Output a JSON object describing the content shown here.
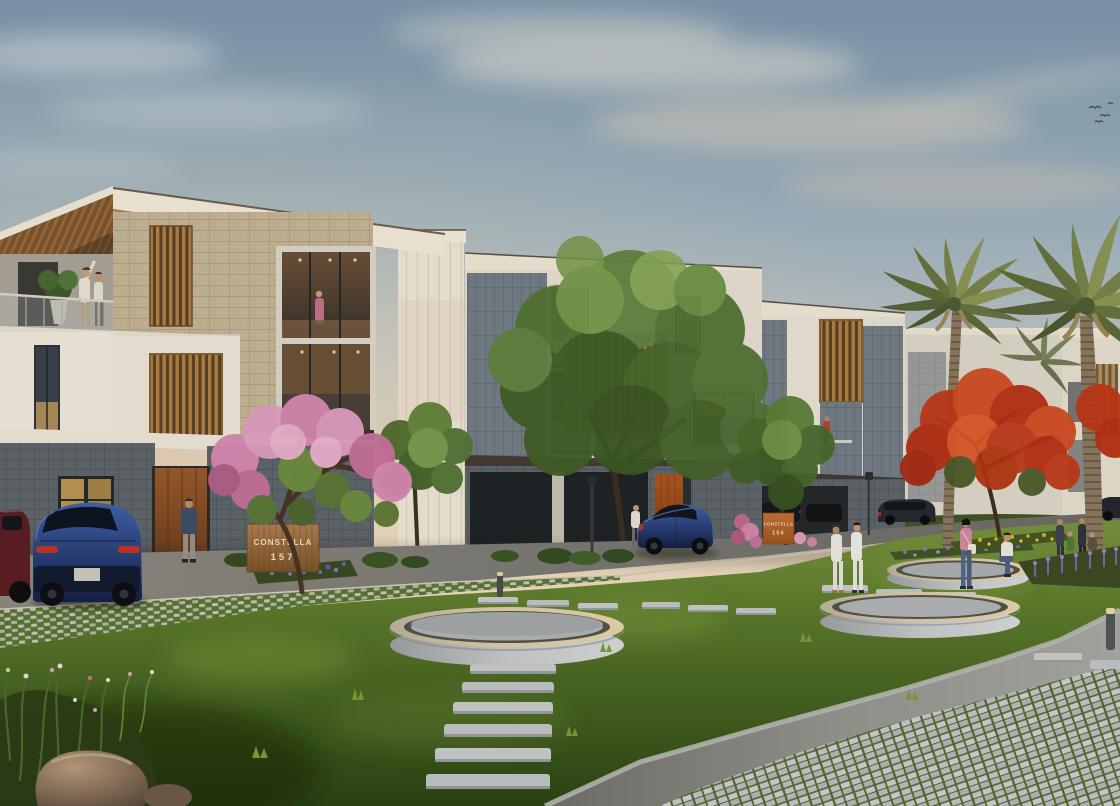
{
  "meta": {
    "title": "Residential community exterior rendering at dusk",
    "type": "architectural-visualization"
  },
  "signs": {
    "unit_left": {
      "name": "CONSTELLA",
      "number": "157"
    },
    "unit_right": {
      "name": "CONSTELLA",
      "number": "156"
    }
  },
  "palette": {
    "sky_top": "#7e98ae",
    "sky_horizon": "#f4e3c8",
    "stucco": "#f0e8d9",
    "stucco_shade": "#e4dccd",
    "stone_beige": "#c6b697",
    "stone_grey": "#78818a",
    "stone_dark": "#5f666c",
    "wood": "#b5803f",
    "wood_dark": "#55422a",
    "fascia_dark": "#423c36",
    "window_dark": "#2b333d",
    "window_lit": "#e9b261",
    "grass_light": "#7a9440",
    "grass_dark": "#2b4314",
    "asphalt": "#7b7873",
    "curb": "#d6cfc0",
    "paver_light": "#c6c9c4",
    "planter_band": "#ddcda8",
    "planter_dark": "#56524b",
    "planter_wall": "#c8cbcd",
    "sign_orange": "#c77134",
    "sign_wood": "#a57544",
    "sign_text": "#f3e2c2",
    "flame_red": "#c9401b",
    "pink_bloom": "#d98ab4",
    "palm_green": "#6d7c45",
    "trunk_brown": "#8c7a60",
    "car_blue": "#2e4fa6",
    "car_maroon": "#5c1d22",
    "lavender": "#8a74b8",
    "yellow_bloom": "#d4b82a",
    "white_clothes": "#eceae4"
  },
  "scene_objects": {
    "buildings": [
      "left-townhouse",
      "middle-townhouse",
      "right-townhouse",
      "background-buildings"
    ],
    "vegetation": [
      "plumeria-tree",
      "green-tree-small",
      "green-tree-large",
      "green-tree-right",
      "flame-tree",
      "palm-tree-1",
      "palm-tree-2",
      "lavender-beds",
      "yellow-flower-bed",
      "blue-flower-bed",
      "bougainvillea",
      "lawn",
      "foreground-grasses"
    ],
    "hardscape": [
      "road",
      "curb",
      "grass-joint-paver-driveway",
      "paver-plaza",
      "stepping-stones",
      "ring-planter-center",
      "ring-planter-near",
      "ring-planter-far",
      "rock"
    ],
    "vehicles": [
      "maroon-car",
      "blue-suv-left",
      "blue-suv-middle",
      "dark-car-right-1",
      "dark-car-right-2"
    ],
    "people_count": 13,
    "lighting": [
      "street-lamp-1",
      "street-lamp-2",
      "bollard-light-1",
      "bollard-light-2"
    ],
    "sky": [
      "clouds",
      "birds"
    ]
  }
}
